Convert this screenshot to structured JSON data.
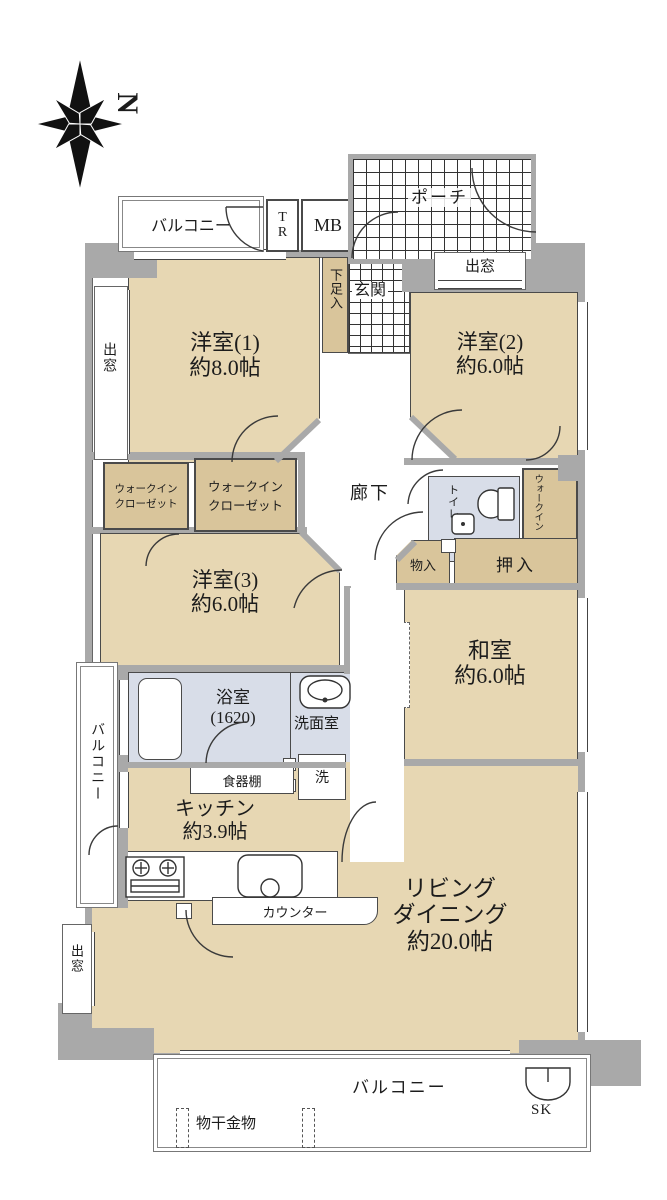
{
  "compass": {
    "north_label": "N"
  },
  "top_row": {
    "balcony": "バルコニー",
    "trunk": "TR",
    "meter_box": "MB",
    "porch": "ポーチ",
    "bay_window": "出窓"
  },
  "entrance": {
    "genkan": "玄関",
    "shoe_box": "下足入"
  },
  "rooms": {
    "western1": {
      "name": "洋室(1)",
      "size": "約8.0帖"
    },
    "western2": {
      "name": "洋室(2)",
      "size": "約6.0帖"
    },
    "western3": {
      "name": "洋室(3)",
      "size": "約6.0帖"
    },
    "japanese": {
      "name": "和室",
      "size": "約6.0帖"
    },
    "kitchen": {
      "name": "キッチン",
      "size": "約3.9帖"
    },
    "living": {
      "line1": "リビング",
      "line2": "ダイニング",
      "size": "約20.0帖"
    }
  },
  "hallway": {
    "label": "廊下"
  },
  "closets": {
    "wic_line1": "ウォークイン",
    "wic_line2": "クローゼット",
    "mono": "物入",
    "oshiire": "押入"
  },
  "sanitary": {
    "toilet": "トイレ",
    "bath_name": "浴室",
    "bath_size": "(1620)",
    "washroom": "洗面室",
    "laundry": "洗",
    "cupboard": "食器棚",
    "counter": "カウンター"
  },
  "left_side": {
    "bay_window_upper": "出窓",
    "balcony": "バルコニー",
    "bay_window_lower": "出窓"
  },
  "bottom": {
    "balcony": "バルコニー",
    "laundry_hanger": "物干金物",
    "sink": "SK"
  },
  "colors": {
    "room": "#e7d7b3",
    "closet": "#d9c59b",
    "wet": "#d8dde8",
    "wall": "#a9a9a9"
  }
}
